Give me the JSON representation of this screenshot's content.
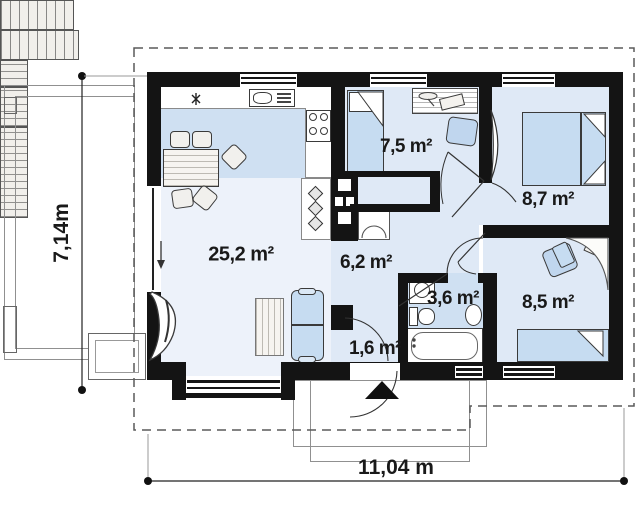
{
  "floor_plan": {
    "rooms": [
      {
        "name": "living-room-with-kitchen",
        "area_label": "25,2 m²"
      },
      {
        "name": "bedroom-top",
        "area_label": "7,5 m²"
      },
      {
        "name": "bedroom-right-top",
        "area_label": "8,7 m²"
      },
      {
        "name": "hallway",
        "area_label": "6,2 m²"
      },
      {
        "name": "bathroom",
        "area_label": "3,6 m²"
      },
      {
        "name": "bedroom-right-bottom",
        "area_label": "8,5 m²"
      },
      {
        "name": "vestibule",
        "area_label": "1,6 m²"
      }
    ],
    "dimensions": {
      "height_label": "7,14m",
      "width_label": "11,04 m"
    },
    "colors": {
      "wall": "#141414",
      "bedroom_floor": "#dfe9f6",
      "kitchen_floor": "#cfe0f2",
      "living_floor": "#edf2fa",
      "furniture_blue": "#c6dcf1"
    }
  }
}
